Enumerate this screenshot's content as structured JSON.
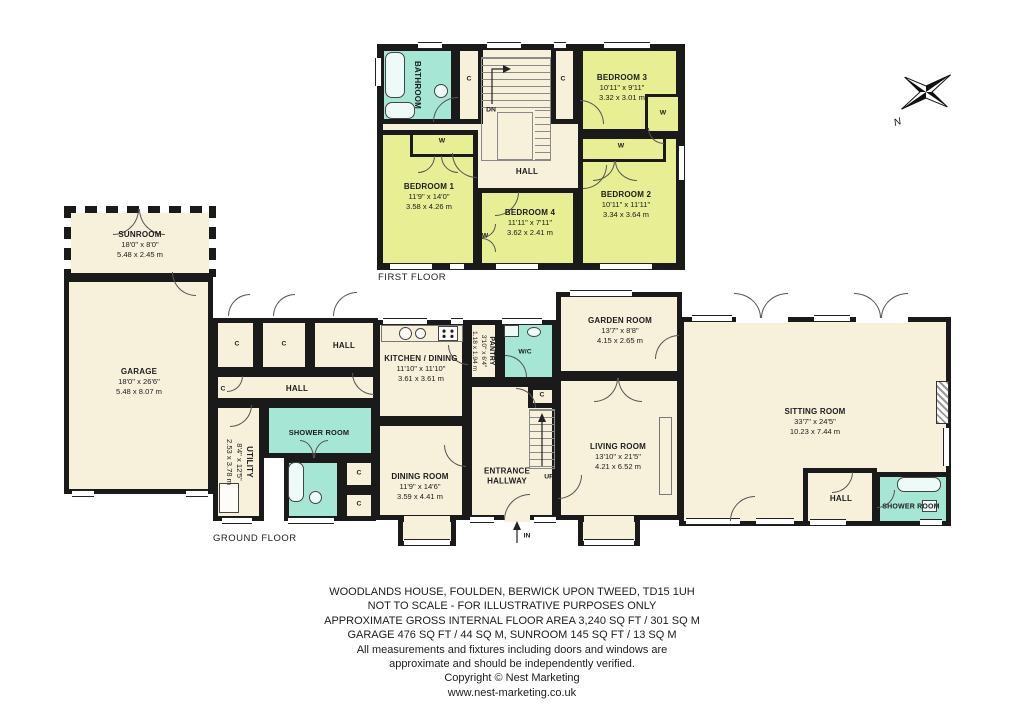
{
  "floors": {
    "first": {
      "label": "FIRST FLOOR"
    },
    "ground": {
      "label": "GROUND FLOOR"
    }
  },
  "rooms": {
    "bathroom": {
      "name": "BATHROOM"
    },
    "bedroom1": {
      "name": "BEDROOM 1",
      "ft": "11'9\" x 14'0\"",
      "m": "3.58 x 4.26 m"
    },
    "bedroom2": {
      "name": "BEDROOM 2",
      "ft": "10'11\" x 11'11\"",
      "m": "3.34 x 3.64 m"
    },
    "bedroom3": {
      "name": "BEDROOM 3",
      "ft": "10'11\" x 9'11\"",
      "m": "3.32 x 3.01 m"
    },
    "bedroom4": {
      "name": "BEDROOM 4",
      "ft": "11'11\" x 7'11\"",
      "m": "3.62 x 2.41 m"
    },
    "sunroom": {
      "name": "SUNROOM",
      "ft": "18'0\" x 8'0\"",
      "m": "5.48 x 2.45 m"
    },
    "garage": {
      "name": "GARAGE",
      "ft": "18'0\" x 26'6\"",
      "m": "5.48 x 8.07 m"
    },
    "utility": {
      "name": "UTILITY",
      "ft": "8'4\" x 12'5\"",
      "m": "2.53 x 3.78 m"
    },
    "shower_mid": {
      "name": "SHOWER ROOM"
    },
    "kitchen": {
      "name": "KITCHEN / DINING",
      "ft": "11'10\" x 11'10\"",
      "m": "3.61 x 3.61 m"
    },
    "pantry": {
      "name": "PANTRY",
      "ft": "3'10\" x 6'4\"",
      "m": "1.18 x 1.94 m"
    },
    "wc": {
      "name": "W/C"
    },
    "dining": {
      "name": "DINING ROOM",
      "ft": "11'9\" x 14'6\"",
      "m": "3.59 x 4.41 m"
    },
    "entrance": {
      "line1": "ENTRANCE",
      "line2": "HALLWAY"
    },
    "garden": {
      "name": "GARDEN ROOM",
      "ft": "13'7\" x 8'8\"",
      "m": "4.15 x 2.65 m"
    },
    "living": {
      "name": "LIVING ROOM",
      "ft": "13'10\" x 21'5\"",
      "m": "4.21 x 6.52 m"
    },
    "sitting": {
      "name": "SITTING ROOM",
      "ft": "33'7\" x 24'5\"",
      "m": "10.23 x 7.44 m"
    },
    "hall_right": {
      "name": "HALL"
    },
    "shower_right": {
      "name": "SHOWER ROOM"
    }
  },
  "labels": {
    "hall": "HALL"
  },
  "glyphs": {
    "closet": "C",
    "wardrobe": "W",
    "down": "DN",
    "up": "UP",
    "in": "IN",
    "north": "N"
  },
  "footer": {
    "lines": [
      "WOODLANDS HOUSE, FOULDEN, BERWICK UPON TWEED, TD15 1UH",
      "NOT TO SCALE - FOR ILLUSTRATIVE PURPOSES ONLY",
      "APPROXIMATE GROSS INTERNAL FLOOR AREA 3,240 SQ FT / 301 SQ M",
      "GARAGE 476 SQ FT / 44 SQ M, SUNROOM 145 SQ FT / 13 SQ M",
      "All measurements and fixtures including doors and windows are",
      "approximate and should be independently verified.",
      "Copyright © Nest Marketing",
      "www.nest-marketing.co.uk"
    ]
  },
  "colors": {
    "room_fill": "#F7F1DC",
    "bedroom_fill": "#E7EE93",
    "wet_room_fill": "#A6E6D5",
    "wall": "#1A1A1A"
  }
}
